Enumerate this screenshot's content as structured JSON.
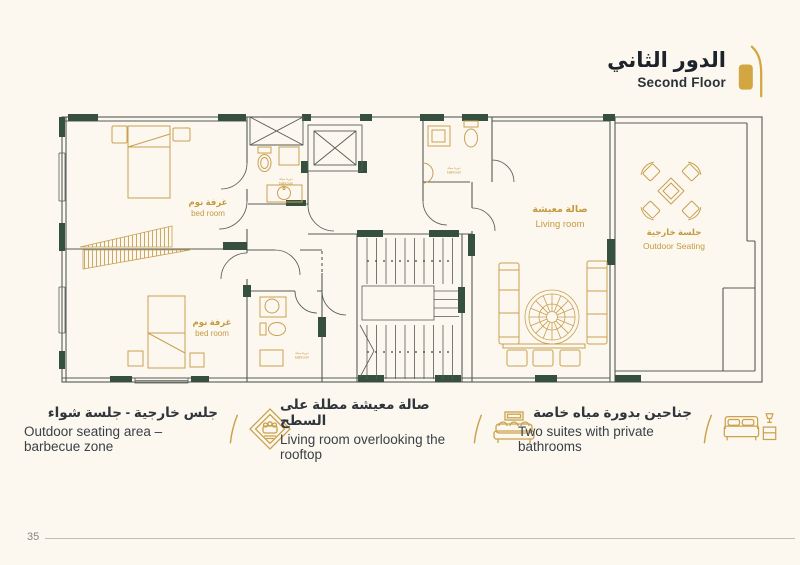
{
  "page": {
    "number": "35"
  },
  "header": {
    "title_ar": "الدور الثاني",
    "title_en": "Second Floor",
    "icon": "door-icon"
  },
  "plan": {
    "rooms": {
      "bedroom_top": {
        "ar": "غرفة نوم",
        "en": "bed room"
      },
      "bedroom_bottom": {
        "ar": "غرفة نوم",
        "en": "bed room"
      },
      "living": {
        "ar": "صالة معيشة",
        "en": "Living room"
      },
      "outdoor": {
        "ar": "جلسة خارجية",
        "en": "Outdoor Seating"
      },
      "bath": {
        "ar": "دورة مياه",
        "en": "bathroom"
      }
    }
  },
  "legend": {
    "items": [
      {
        "id": "outdoor-bbq",
        "icon": "majlis-ornament-icon",
        "ar": "جلس خارجية - جلسة شواء",
        "en": "Outdoor seating area – barbecue zone"
      },
      {
        "id": "living-rooftop",
        "icon": "sofa-icon",
        "ar": "صالة معيشة مطلة على السطح",
        "en": "Living room overlooking the rooftop"
      },
      {
        "id": "two-suites",
        "icon": "bed-icon",
        "ar": "جناحين بدورة مياه خاصة",
        "en": "Two suites with private bathrooms"
      }
    ]
  },
  "colors": {
    "gold": "#c9a24b",
    "wall": "#35503f",
    "line": "#565b54",
    "label_gold": "#c49a3f",
    "bg": "#fcf8f0"
  }
}
